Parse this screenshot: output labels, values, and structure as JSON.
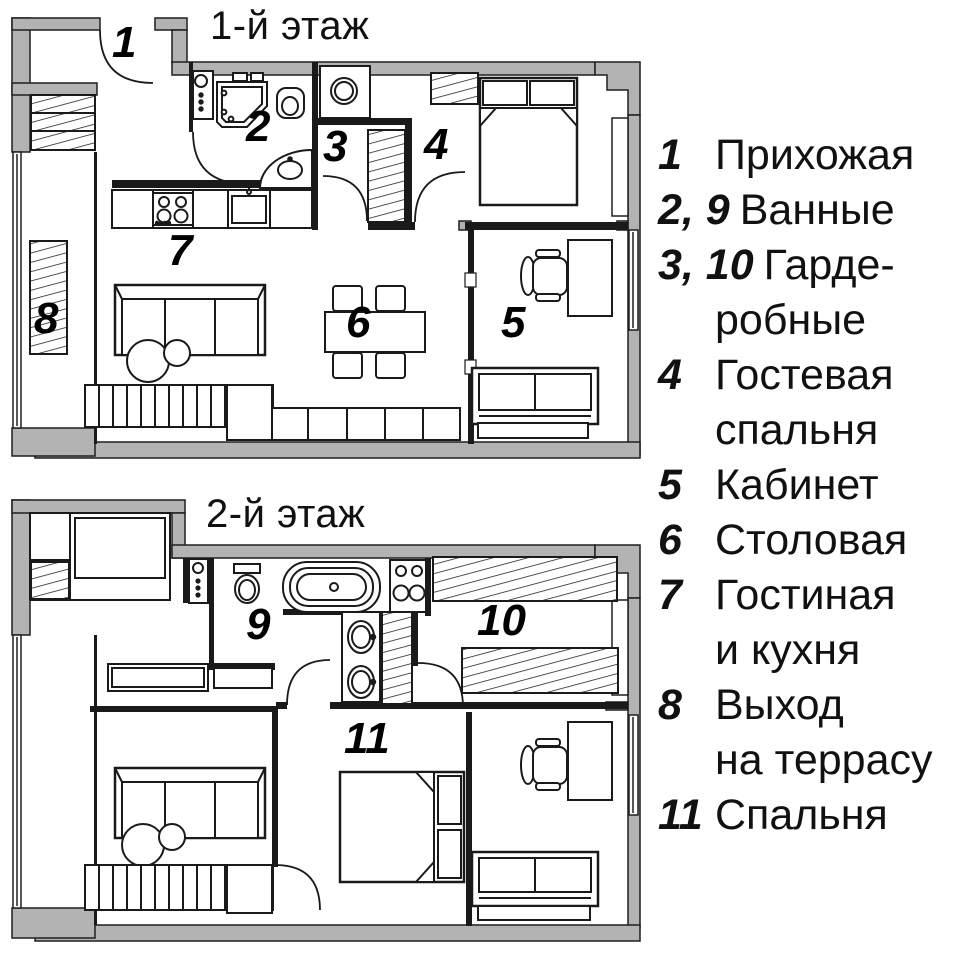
{
  "floor1": {
    "title": "1-й этаж",
    "labels": {
      "r1": "1",
      "r2": "2",
      "r3": "3",
      "r4": "4",
      "r5": "5",
      "r6": "6",
      "r7": "7",
      "r8": "8"
    }
  },
  "floor2": {
    "title": "2-й этаж",
    "labels": {
      "r9": "9",
      "r10": "10",
      "r11": "11"
    }
  },
  "legend": {
    "items": [
      {
        "numbers": "1",
        "label": "Прихожая"
      },
      {
        "numbers": "2, 9",
        "label": "Ванные"
      },
      {
        "numbers": "3, 10",
        "label": "Гарде-\nробные"
      },
      {
        "numbers": "4",
        "label": "Гостевая\nспальня"
      },
      {
        "numbers": "5",
        "label": "Кабинет"
      },
      {
        "numbers": "6",
        "label": "Столовая"
      },
      {
        "numbers": "7",
        "label": "Гостиная\nи кухня"
      },
      {
        "numbers": "8",
        "label": "Выход\nна террасу"
      },
      {
        "numbers": "11",
        "label": "Спальня"
      }
    ]
  },
  "colors": {
    "wall_gray": "#b3b3b3",
    "line": "#1a1a1a",
    "background": "#ffffff"
  }
}
